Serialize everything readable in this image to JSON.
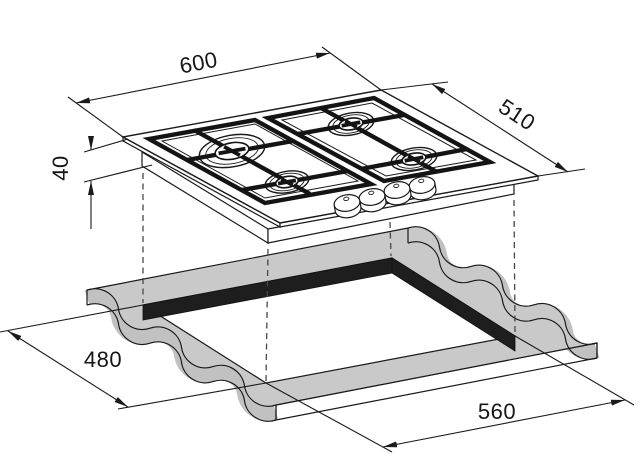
{
  "diagram": {
    "type": "installation-drawing",
    "product": "4-burner gas hob with worktop cutout",
    "dimension_labels": {
      "hob_width_mm": "600",
      "hob_depth_mm": "510",
      "hob_height_mm": "40",
      "cutout_depth_mm": "480",
      "cutout_width_mm": "560"
    },
    "colors": {
      "line": "#1a1a1a",
      "worktop_top": "#c9c9c9",
      "worktop_side": "#c1c1c1",
      "worktop_front": "#c6c6c6",
      "cutout_wall": "#1e1e1e",
      "hob_fill": "#ffffff"
    },
    "counts": {
      "burners": 4,
      "knobs": 4,
      "pan_supports": 2
    }
  }
}
